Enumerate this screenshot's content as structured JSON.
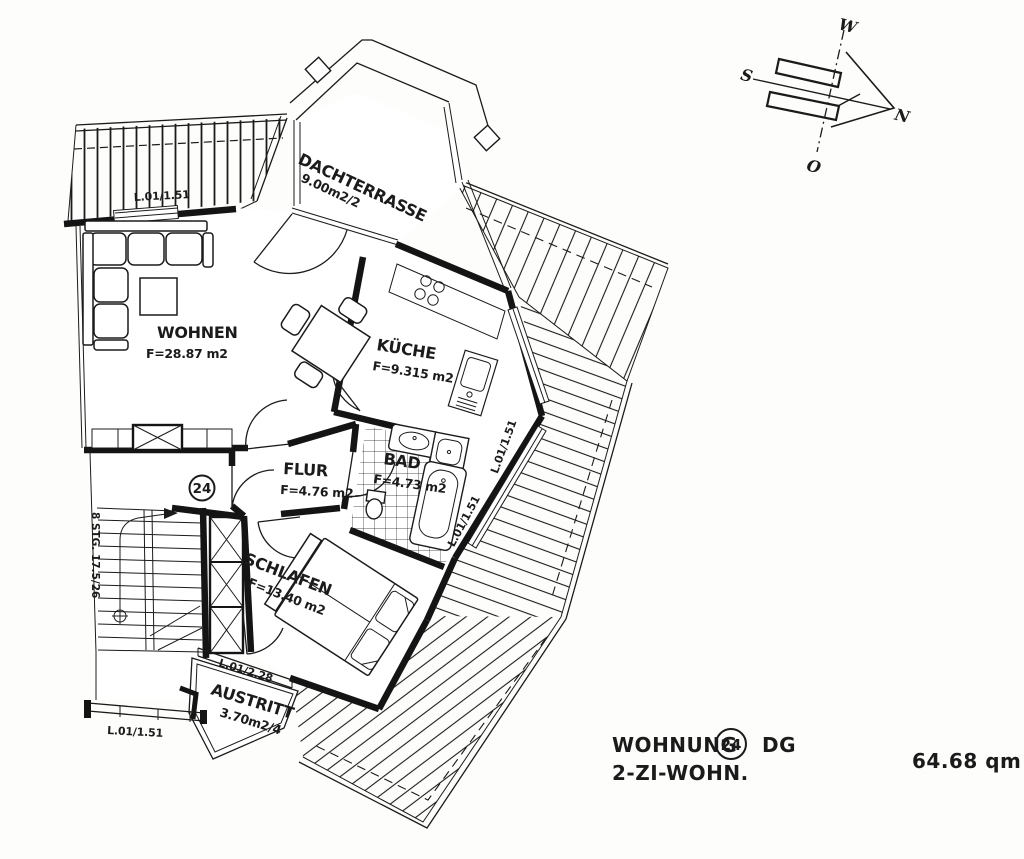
{
  "colors": {
    "ink": "#1b1b1b",
    "paper": "#fdfdfb"
  },
  "title_block": {
    "label": "WOHNUNG",
    "apartment_number": "24",
    "floor": "DG",
    "type": "2-ZI-WOHN.",
    "total_area": "64.68 qm"
  },
  "entrance": {
    "number": "24"
  },
  "stairs": {
    "label": "8 STG. 17.5/26"
  },
  "compass": {
    "n": "N",
    "s": "S",
    "w": "W",
    "o": "O"
  },
  "rooms": {
    "wohnen": {
      "name": "WOHNEN",
      "area": "F=28.87 m2"
    },
    "kueche": {
      "name": "KÜCHE",
      "area": "F=9.315 m2"
    },
    "bad": {
      "name": "BAD",
      "area": "F=4.73 m2"
    },
    "flur": {
      "name": "FLUR",
      "area": "F=4.76 m2"
    },
    "schlafen": {
      "name": "SCHLAFEN",
      "area": "F=13.40 m2"
    },
    "dachterrasse": {
      "name": "DACHTERRASSE",
      "area": "9.00m2/2"
    },
    "austritt": {
      "name": "AUSTRITT",
      "area": "3.70m2/4"
    }
  },
  "windows": {
    "terrace_left": "L.01/1.51",
    "kitchen_right": "L.01/1.51",
    "bath_right": "L.01/1.51",
    "bedroom_exit": "L.01/2.28",
    "stairwell_bottom": "L.01/1.51"
  }
}
